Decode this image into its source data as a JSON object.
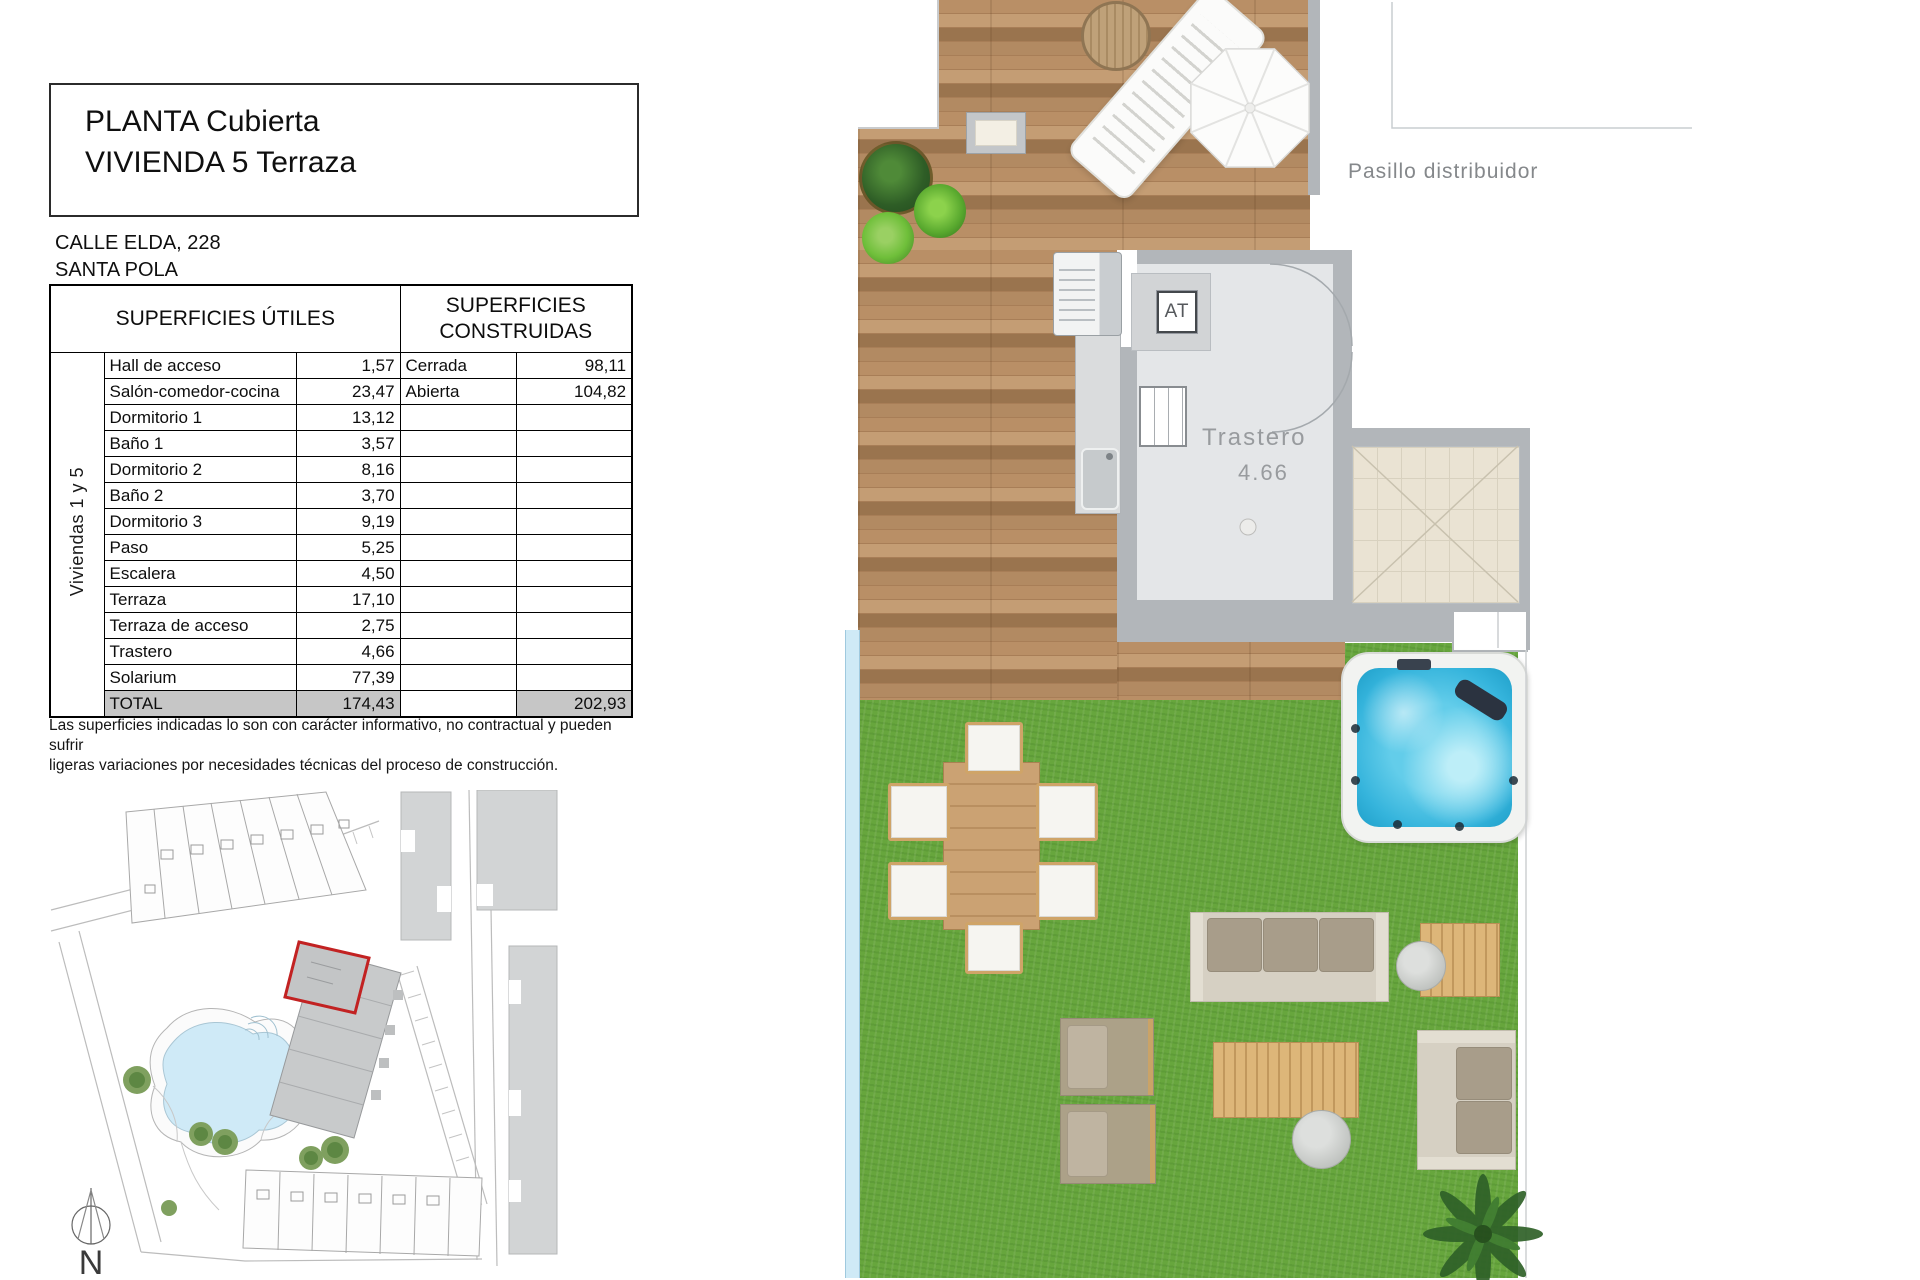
{
  "title_block": {
    "line1": "PLANTA Cubierta",
    "line2": "VIVIENDA 5 Terraza"
  },
  "address": {
    "line1": "CALLE ELDA, 228",
    "line2": "SANTA POLA"
  },
  "surfaces_table": {
    "header_left": "SUPERFICIES ÚTILES",
    "header_right": "SUPERFICIES CONSTRUIDAS",
    "group_label": "Viviendas 1 y 5",
    "rows": [
      {
        "name": "Hall de acceso",
        "value": "1,57",
        "built_name": "Cerrada",
        "built_value": "98,11"
      },
      {
        "name": "Salón-comedor-cocina",
        "value": "23,47",
        "built_name": "Abierta",
        "built_value": "104,82"
      },
      {
        "name": "Dormitorio 1",
        "value": "13,12",
        "built_name": "",
        "built_value": ""
      },
      {
        "name": "Baño 1",
        "value": "3,57",
        "built_name": "",
        "built_value": ""
      },
      {
        "name": "Dormitorio 2",
        "value": "8,16",
        "built_name": "",
        "built_value": ""
      },
      {
        "name": "Baño 2",
        "value": "3,70",
        "built_name": "",
        "built_value": ""
      },
      {
        "name": "Dormitorio 3",
        "value": "9,19",
        "built_name": "",
        "built_value": ""
      },
      {
        "name": "Paso",
        "value": "5,25",
        "built_name": "",
        "built_value": ""
      },
      {
        "name": "Escalera",
        "value": "4,50",
        "built_name": "",
        "built_value": ""
      },
      {
        "name": "Terraza",
        "value": "17,10",
        "built_name": "",
        "built_value": ""
      },
      {
        "name": "Terraza de acceso",
        "value": "2,75",
        "built_name": "",
        "built_value": ""
      },
      {
        "name": "Trastero",
        "value": "4,66",
        "built_name": "",
        "built_value": ""
      },
      {
        "name": "Solarium",
        "value": "77,39",
        "built_name": "",
        "built_value": ""
      }
    ],
    "total": {
      "name": "TOTAL",
      "value": "174,43",
      "built_name": "",
      "built_value": "202,93"
    }
  },
  "note": {
    "line1": "Las superficies indicadas lo son con carácter informativo, no contractual y pueden sufrir",
    "line2": "ligeras variaciones por necesidades técnicas del proceso de construcción."
  },
  "plan_labels": {
    "pasillo": "Pasillo distribuidor",
    "trastero_name": "Trastero",
    "trastero_area": "4.66",
    "at": "AT"
  },
  "site_plan": {
    "north_label": "N"
  },
  "colors": {
    "highlight_red": "#c22222",
    "deck_wood": "#ab8159",
    "grass_green": "#67a63d",
    "jacuzzi_water": "#35b4dc",
    "pool_water": "#cfeaf7",
    "wall_gray": "#b2b6ba",
    "total_row_gray": "#c6c6c6"
  }
}
